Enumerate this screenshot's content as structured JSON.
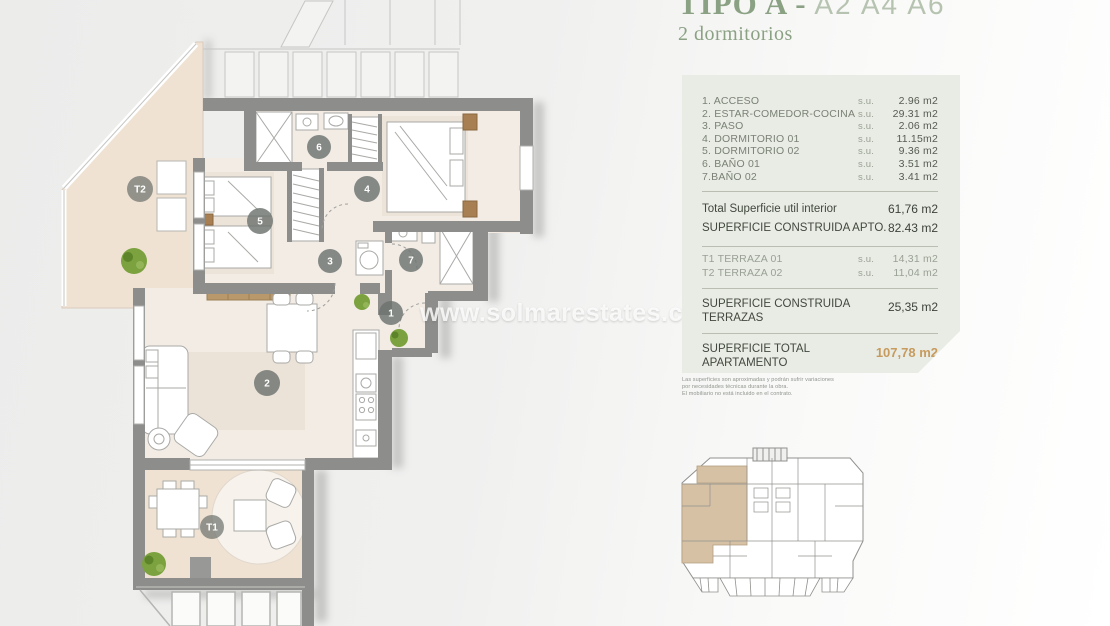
{
  "colors": {
    "accent_green": "#8ba184",
    "accent_orange": "#c79a5e",
    "panel_bg": "#e8ece4",
    "wall_gray": "#8d8d8b",
    "terrace_beige": "#efe2d3"
  },
  "header": {
    "title": "TIPO A -",
    "codes": "A2 A4 A6",
    "subtitle": "2 dormitorios"
  },
  "panel": {
    "rooms": [
      {
        "label": "1. ACCESO",
        "su": "s.u.",
        "value": "2.96 m2"
      },
      {
        "label": "2. ESTAR-COMEDOR-COCINA",
        "su": "s.u.",
        "value": "29.31 m2"
      },
      {
        "label": "3. PASO",
        "su": "s.u.",
        "value": "2.06 m2"
      },
      {
        "label": "4. DORMITORIO 01",
        "su": "s.u.",
        "value": "11.15m2"
      },
      {
        "label": "5. DORMITORIO 02",
        "su": "s.u.",
        "value": "9.36 m2"
      },
      {
        "label": "6. BAÑO 01",
        "su": "s.u.",
        "value": "3.51 m2"
      },
      {
        "label": "7.BAÑO 02",
        "su": "s.u.",
        "value": "3.41 m2"
      }
    ],
    "total_util": {
      "label": "Total Superficie util interior",
      "value": "61,76 m2"
    },
    "construida_apto": {
      "label": "SUPERFICIE CONSTRUIDA APTO.",
      "value": "82.43 m2"
    },
    "terrazas": [
      {
        "label": "T1 TERRAZA 01",
        "su": "s.u.",
        "value": "14,31 m2"
      },
      {
        "label": "T2 TERRAZA 02",
        "su": "s.u.",
        "value": "11,04 m2"
      }
    ],
    "construida_terrazas": {
      "label": "SUPERFICIE CONSTRUIDA TERRAZAS",
      "value": "25,35 m2"
    },
    "total_apartamento": {
      "label": "SUPERFICIE TOTAL APARTAMENTO",
      "value": "107,78 m2"
    }
  },
  "disclaimer": [
    "Las superficies son aproximadas y podrán sufrir variaciones",
    "por necesidades técnicas durante la obra.",
    "El mobiliario no está incluido en el contrato."
  ],
  "watermark": "www.solmarestates.com",
  "plan": {
    "markers": [
      "1",
      "2",
      "3",
      "4",
      "5",
      "6",
      "7",
      "T1",
      "T2"
    ]
  }
}
